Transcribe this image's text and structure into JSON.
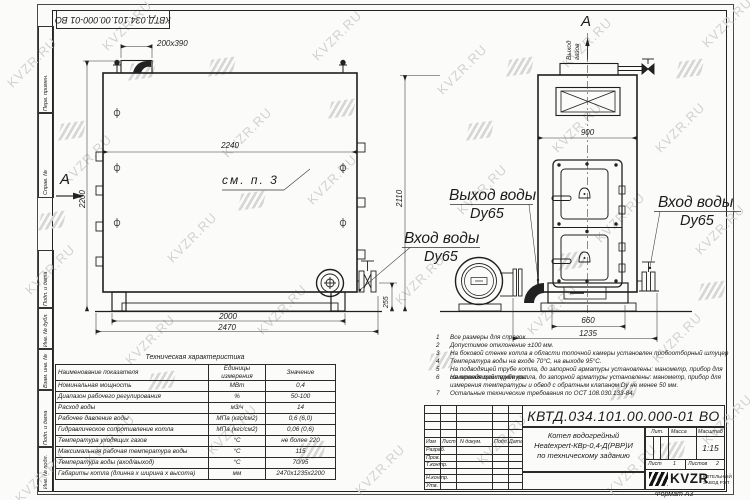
{
  "sheet": {
    "top_stamp": "КВТД.034.101.00.000-01 ВО",
    "format_label": "Формат  А3",
    "watermark": "KVZR.RU"
  },
  "margin_labels": [
    "Перв. примен.",
    "Справ. №",
    "Подп. и дата",
    "Инв. № дубл.",
    "Взам. инв. №",
    "Подп. и дата",
    "Инв. № подл."
  ],
  "drawing": {
    "section_letter_left": "A",
    "section_letter_top": "A",
    "labels": {
      "flue_dim": "200x390",
      "width_top": "2240",
      "see_note": "см. п. 3",
      "height_left": "2200",
      "height_mid": "2110",
      "base_width": "2000",
      "total_length": "2470",
      "conn_height": "255",
      "front_width": "900",
      "front_base": "660",
      "front_total": "1235",
      "gas_out_1": "Выход",
      "gas_out_2": "газов",
      "water_out": "Выход воды",
      "water_out_dn": "Dy65",
      "water_in_left": "Вход воды",
      "water_in_left_dn": "Dy65",
      "water_in_right": "Вход воды",
      "water_in_right_dn": "Dy65"
    }
  },
  "tech_table": {
    "title": "Техническая характеристика",
    "headers": [
      "Наименование показателя",
      "Единицы измерения",
      "Значение"
    ],
    "rows": [
      [
        "Номинальная мощность",
        "МВт",
        "0,4"
      ],
      [
        "Диапазон рабочего регулирования",
        "%",
        "50-100"
      ],
      [
        "Расход воды",
        "м3/ч",
        "14"
      ],
      [
        "Рабочее давление воды",
        "МПа (кгс/см2)",
        "0,6 (6,0)"
      ],
      [
        "Гидравлическое сопротивление котла",
        "МПа (кгс/см2)",
        "0,06 (0,6)"
      ],
      [
        "Температура уходящих газов",
        "°С",
        "не более 220"
      ],
      [
        "Максимальная рабочая температура воды",
        "°С",
        "115"
      ],
      [
        "Температура воды (вход/выход)",
        "°С",
        "70/95"
      ],
      [
        "Габариты котла (длинна х ширина х высота)",
        "мм",
        "2470х1235х2200"
      ]
    ]
  },
  "notes": [
    {
      "n": "1",
      "text": "Все размеры для справок"
    },
    {
      "n": "2",
      "text": "Допустимое отклонение ±100 мм."
    },
    {
      "n": "3",
      "text": "На боковой стенке котла в области топочной камеры установлен пробоотборный штуцер"
    },
    {
      "n": "4",
      "text": "Температура воды на входе 70°С, на выходе 95°С."
    },
    {
      "n": "5",
      "text": "На  подводящей трубе котла, до запорной арматуры установлены: манометр, прибор для измерения температуры."
    },
    {
      "n": "6",
      "text": "На отводящей трубе котла, до запорной арматуры установлены: манометр, прибор для измерения температуры и обвод с обратным клапаном Dу не менее 50 мм."
    },
    {
      "n": "7",
      "text": "Остальные технические требования по ОСТ 108.030.133-84."
    }
  ],
  "title_block": {
    "designation": "КВТД.034.101.00.000-01  ВО",
    "name_line1": "Котел водогрейный",
    "name_line2": "Heatexpert-КВр-0,4-Д(РВР)И",
    "name_line3": "по техническому заданию",
    "header_cols": [
      "Изм",
      "Лист",
      "N докум.",
      "Подп.",
      "Дата"
    ],
    "rows": [
      "Разраб.",
      "Пров.",
      "Т.контр.",
      "Н.контр.",
      "Утв."
    ],
    "lit_label": "Лит.",
    "mass_label": "Масса",
    "scale_label": "Масштаб",
    "scale_value": "1:15",
    "sheet_label": "Лист",
    "sheet_value": "1",
    "sheets_label": "Листов",
    "sheets_value": "2",
    "logo_text": "KVZR",
    "logo_caption_1": "КОТЕЛЬНЫЙ",
    "logo_caption_2": "ЗАВОД РЭП"
  }
}
